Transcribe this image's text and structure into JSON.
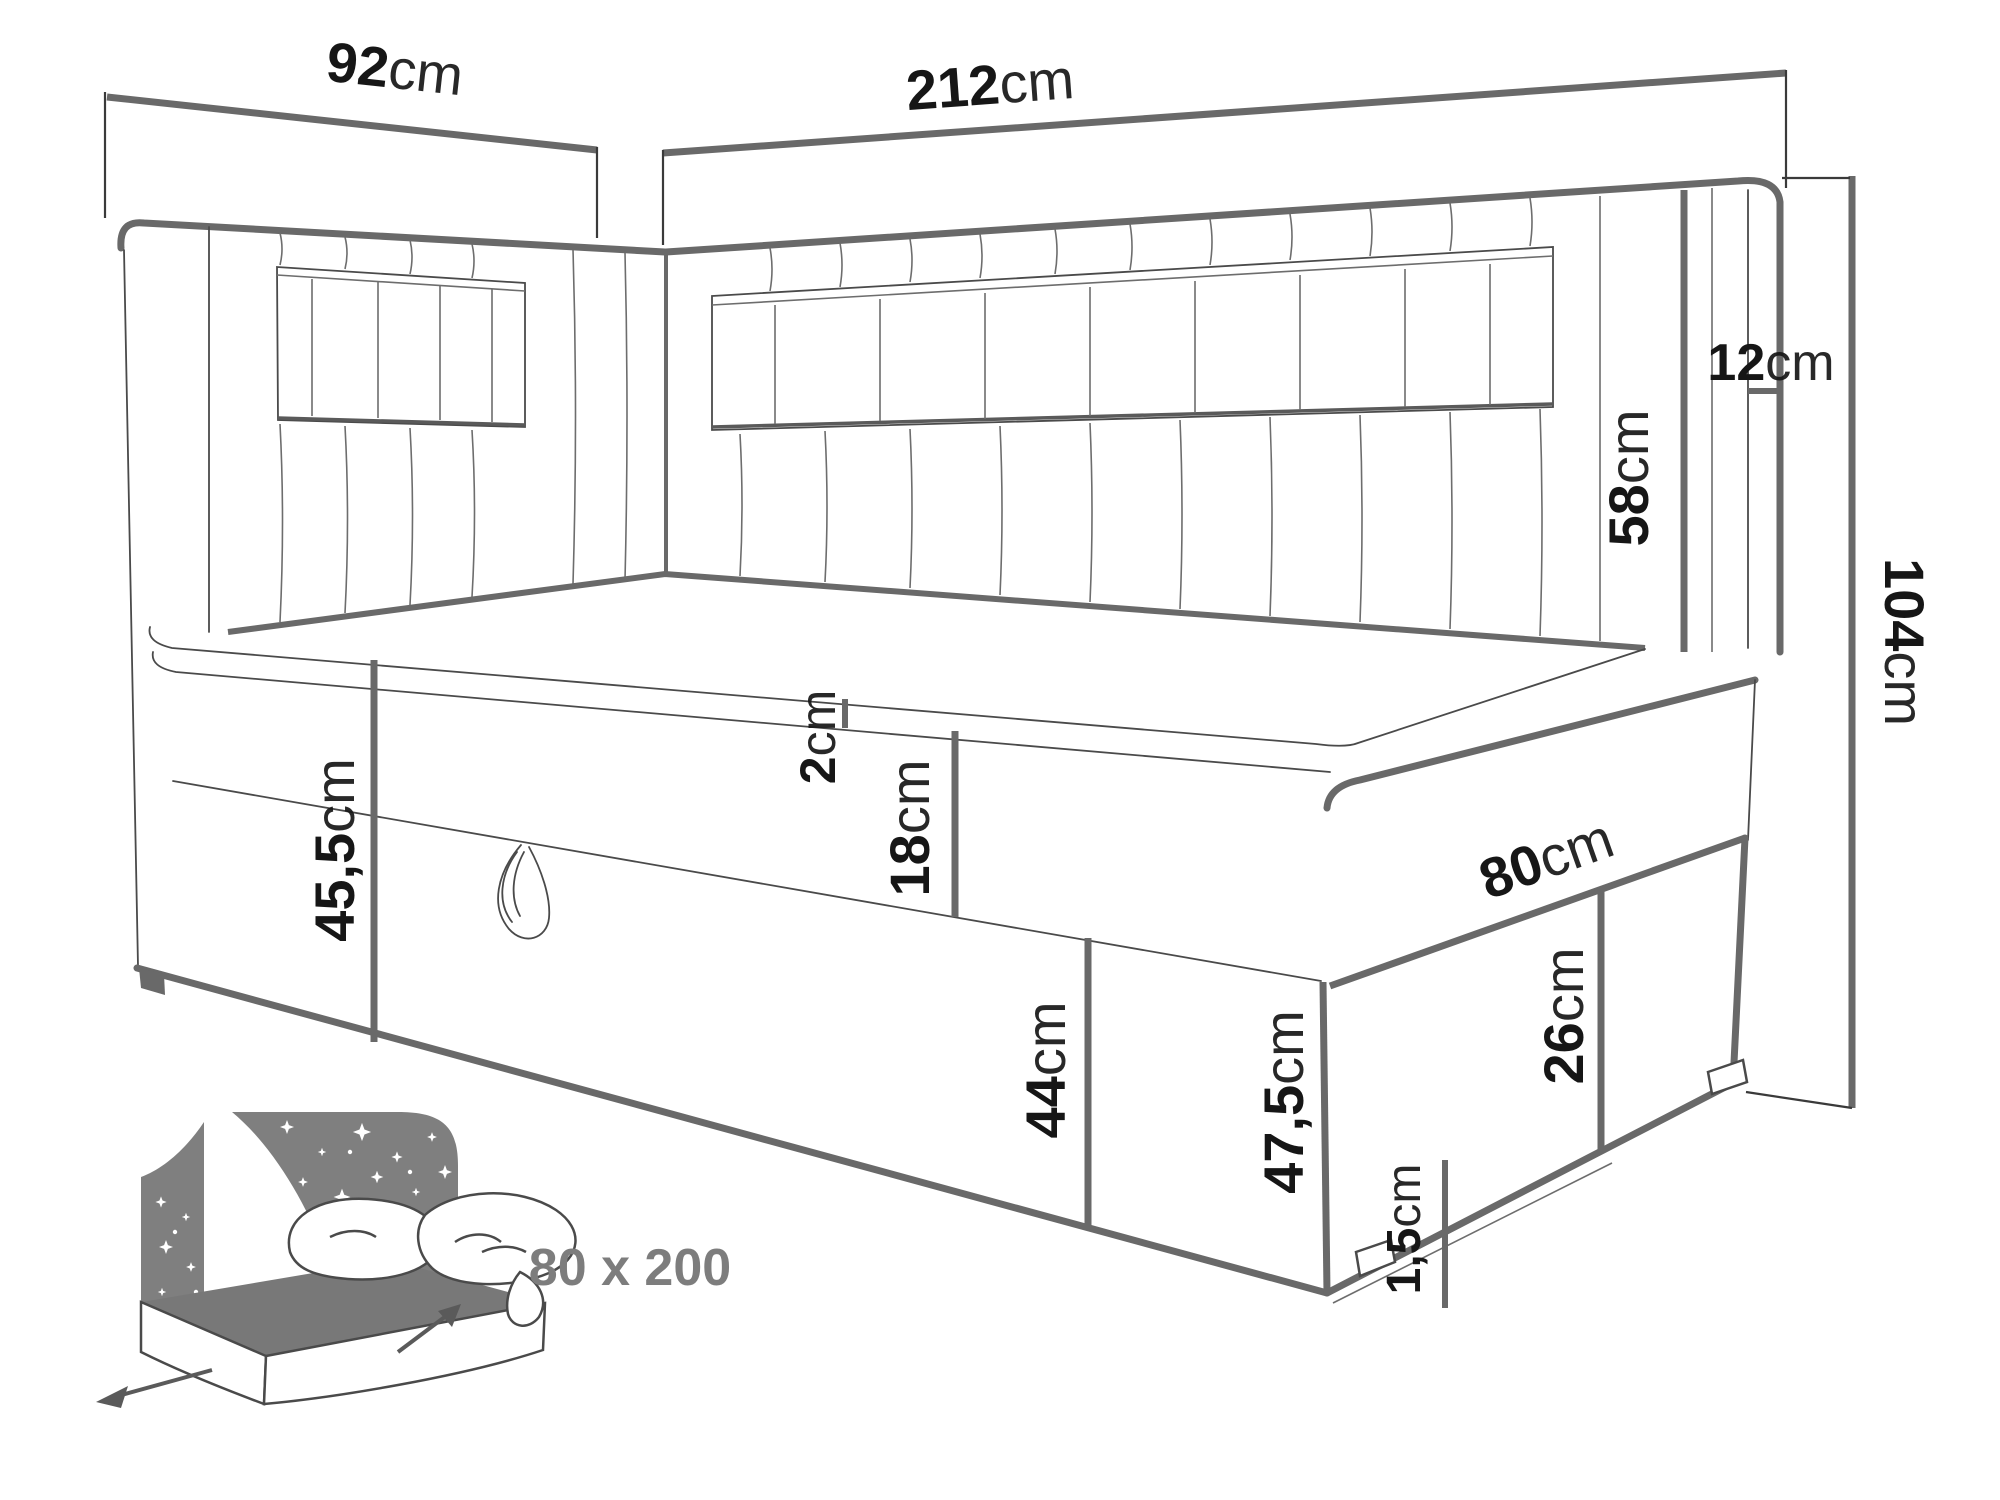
{
  "diagram": {
    "kind": "bed dimension line drawing",
    "colors": {
      "main_line": "#696969",
      "detail_line": "#4a4a4a",
      "label_text": "#161616",
      "badge_text": "#7d7d7d",
      "icon_gray": "#7f7f7f",
      "background": "#ffffff"
    }
  },
  "dimensions": {
    "d92": {
      "value": "92",
      "unit": "cm"
    },
    "d212": {
      "value": "212",
      "unit": "cm"
    },
    "d12": {
      "value": "12",
      "unit": "cm"
    },
    "d58": {
      "value": "58",
      "unit": "cm"
    },
    "d104": {
      "value": "104",
      "unit": "cm"
    },
    "d45_5": {
      "value": "45,5",
      "unit": "cm"
    },
    "d2": {
      "value": "2",
      "unit": "cm"
    },
    "d18": {
      "value": "18",
      "unit": "cm"
    },
    "d44": {
      "value": "44",
      "unit": "cm"
    },
    "d80": {
      "value": "80",
      "unit": "cm"
    },
    "d26": {
      "value": "26",
      "unit": "cm"
    },
    "d47_5": {
      "value": "47,5",
      "unit": "cm"
    },
    "d1_5": {
      "value": "1,5",
      "unit": "cm"
    }
  },
  "size_badge": {
    "text": "80 x 200"
  }
}
